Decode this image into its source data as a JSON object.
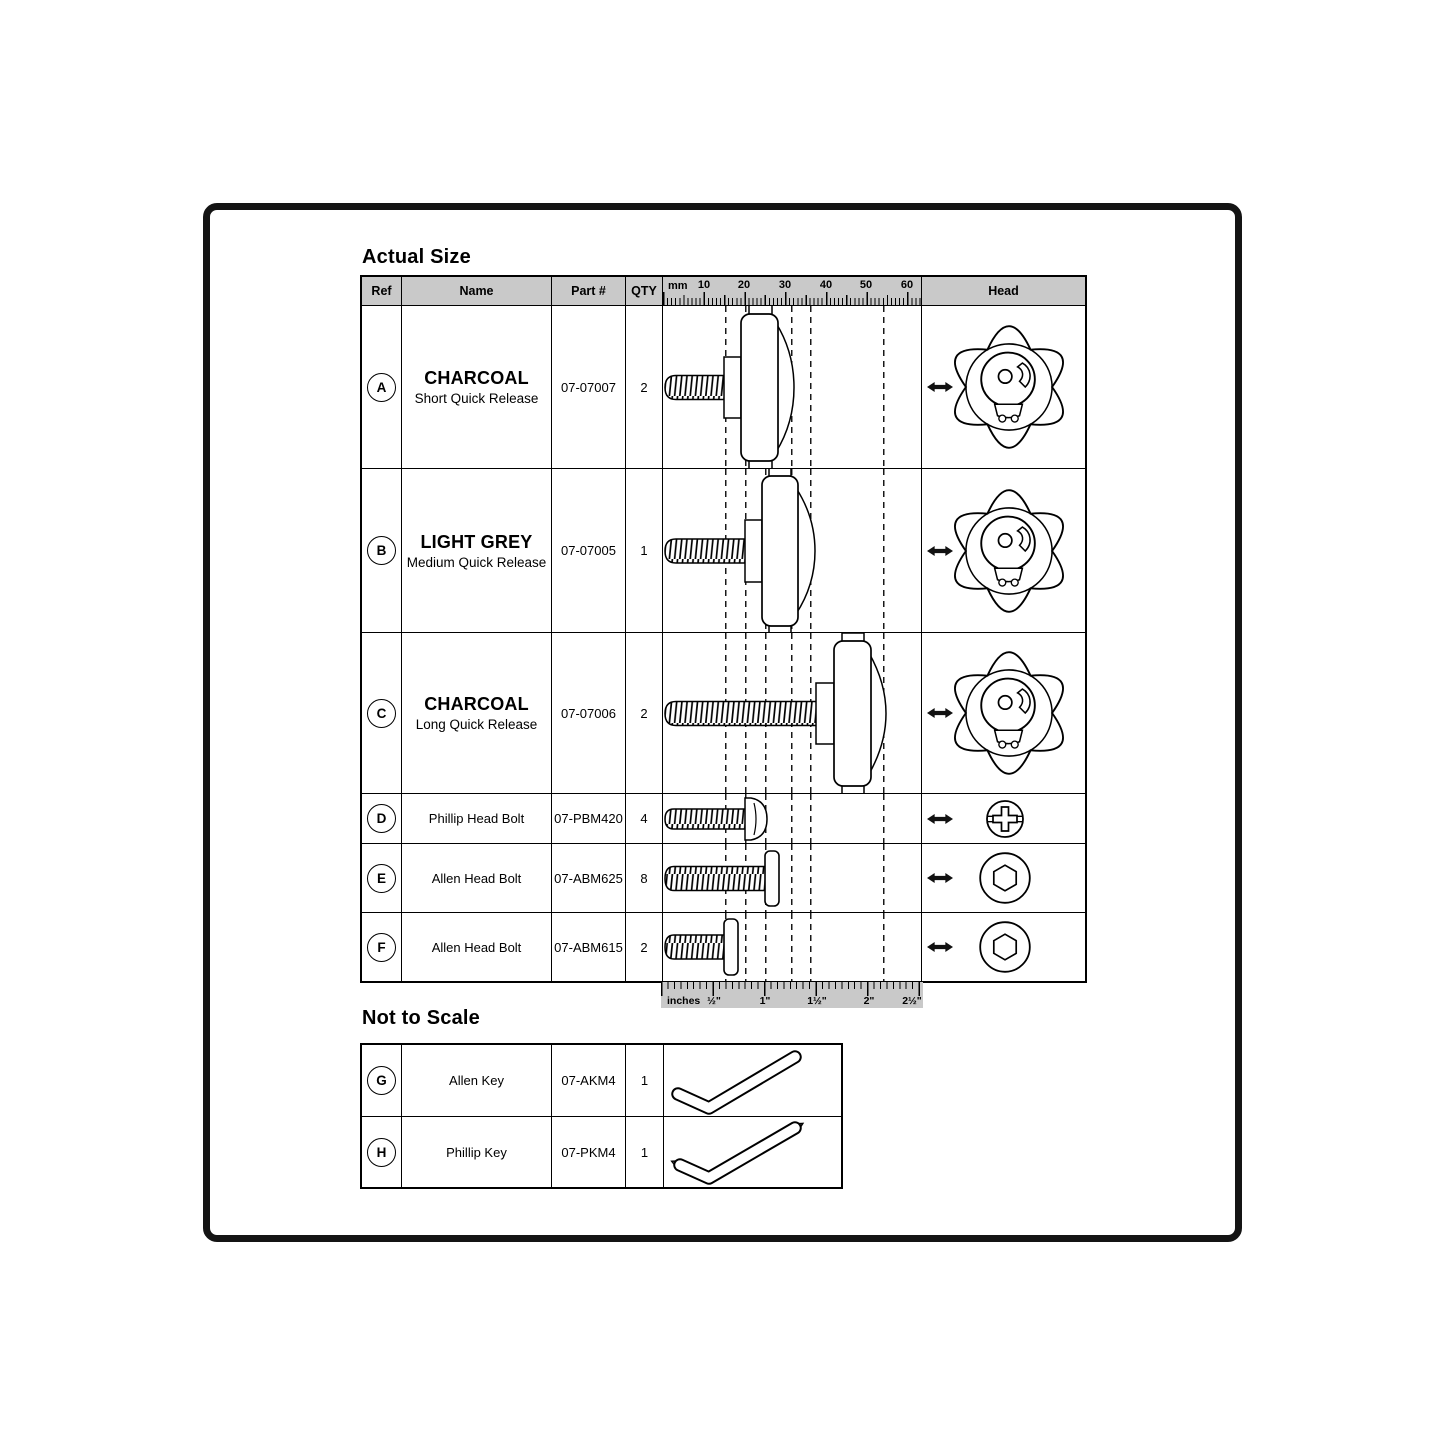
{
  "titles": {
    "actual_size": "Actual Size",
    "not_to_scale": "Not to Scale"
  },
  "colors": {
    "line": "#000000",
    "header_bg": "#c9c9c9",
    "ruler_bg": "#c9c9c9",
    "frame": "#141414"
  },
  "main_table": {
    "headers": {
      "ref": "Ref",
      "name": "Name",
      "part": "Part #",
      "qty": "QTY",
      "head": "Head"
    },
    "rows": [
      {
        "ref": "A",
        "name": "CHARCOAL",
        "subname": "Short Quick Release",
        "part": "07-07007",
        "qty": "2",
        "head_icon": "star-knob",
        "diagram_icon": "short-quick-release-side"
      },
      {
        "ref": "B",
        "name": "LIGHT GREY",
        "subname": "Medium Quick Release",
        "part": "07-07005",
        "qty": "1",
        "head_icon": "star-knob",
        "diagram_icon": "medium-quick-release-side"
      },
      {
        "ref": "C",
        "name": "CHARCOAL",
        "subname": "Long Quick Release",
        "part": "07-07006",
        "qty": "2",
        "head_icon": "star-knob",
        "diagram_icon": "long-quick-release-side"
      },
      {
        "ref": "D",
        "name": "Phillip Head Bolt",
        "part": "07-PBM420",
        "qty": "4",
        "head_icon": "phillips-head-top",
        "diagram_icon": "phillips-bolt-side"
      },
      {
        "ref": "E",
        "name": "Allen Head Bolt",
        "part": "07-ABM625",
        "qty": "8",
        "head_icon": "hex-socket-top",
        "diagram_icon": "allen-bolt-side"
      },
      {
        "ref": "F",
        "name": "Allen Head Bolt",
        "part": "07-ABM615",
        "qty": "2",
        "head_icon": "hex-socket-top",
        "diagram_icon": "allen-bolt-side"
      }
    ]
  },
  "ruler_mm": {
    "unit": "mm",
    "labels": [
      "10",
      "20",
      "30",
      "40",
      "50",
      "60"
    ]
  },
  "ruler_inches": {
    "unit": "inches",
    "labels": [
      "½\"",
      "1\"",
      "1½\"",
      "2\"",
      "2½\""
    ]
  },
  "not_to_scale_table": {
    "rows": [
      {
        "ref": "G",
        "name": "Allen Key",
        "part": "07-AKM4",
        "qty": "1",
        "tool_icon": "allen-key"
      },
      {
        "ref": "H",
        "name": "Phillip Key",
        "part": "07-PKM4",
        "qty": "1",
        "tool_icon": "phillips-key"
      }
    ]
  }
}
